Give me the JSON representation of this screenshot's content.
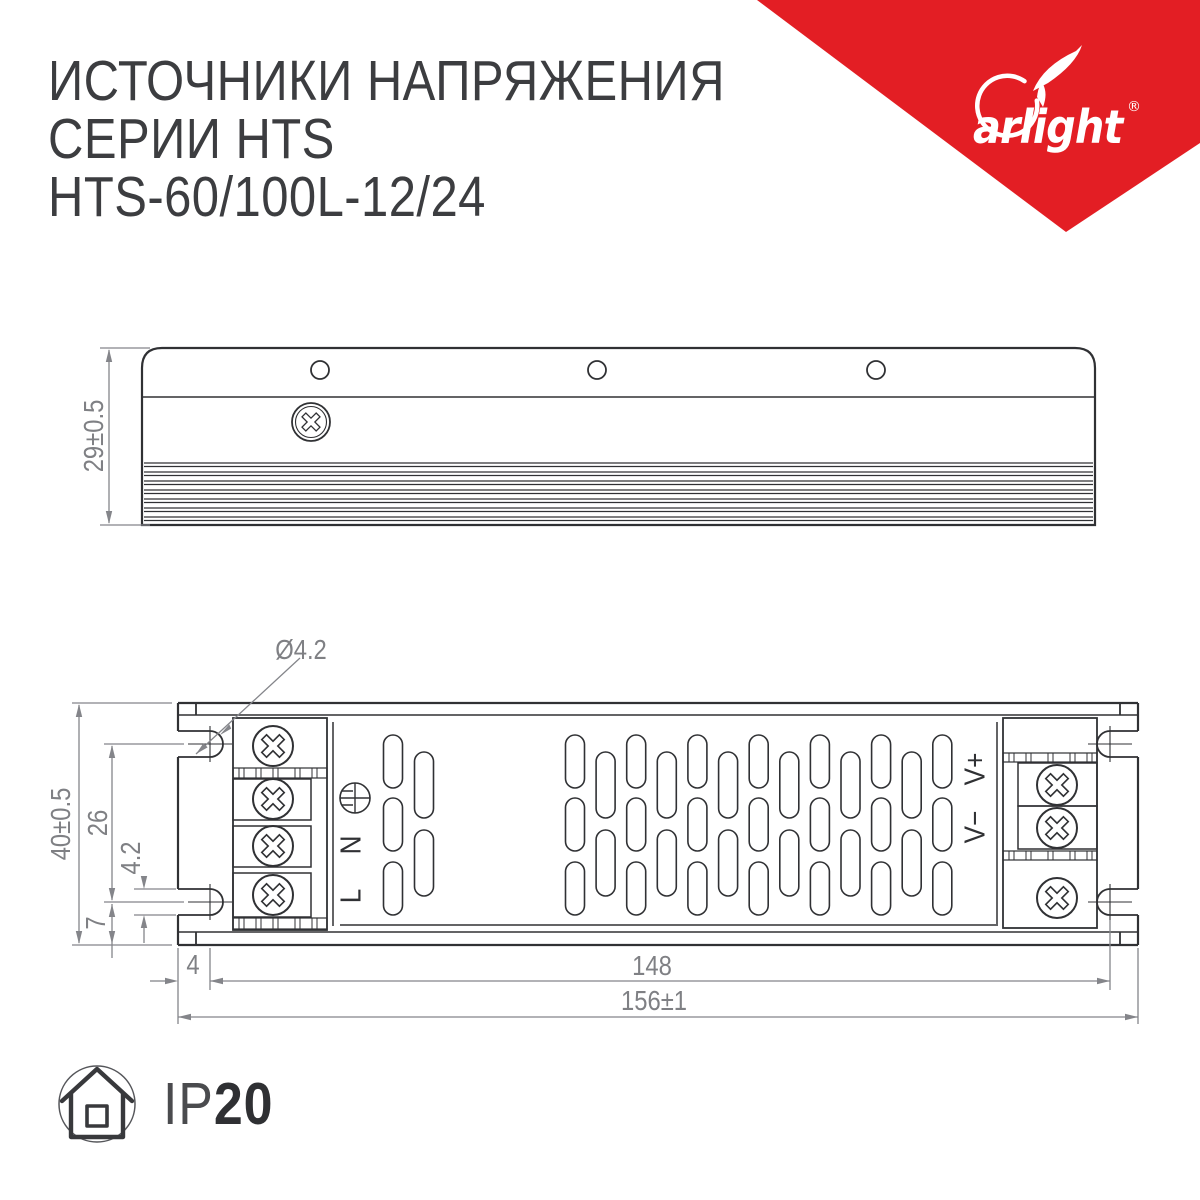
{
  "header": {
    "title_line1": "ИСТОЧНИКИ НАПРЯЖЕНИЯ",
    "title_line2": "СЕРИИ HTS",
    "model": "HTS-60/100L-12/24"
  },
  "brand": {
    "wordmark": "arlight",
    "registered": "®",
    "red": "#E31E24"
  },
  "side_view": {
    "dim_height": "29±0.5"
  },
  "top_view": {
    "hole_diameter": "Ø4.2",
    "dim_total_height": "40±0.5",
    "dim_slot_spacing_v": "26",
    "dim_slot_width": "4.2",
    "dim_slot_offset_v": "7",
    "dim_slot_offset_h": "4",
    "dim_slot_spacing_h": "148",
    "dim_total_width": "156±1",
    "terminal_n": "N",
    "terminal_l": "L",
    "terminal_vplus": "V+",
    "terminal_vminus": "V−"
  },
  "footer": {
    "ip_prefix": "IP",
    "ip_value": "20"
  }
}
